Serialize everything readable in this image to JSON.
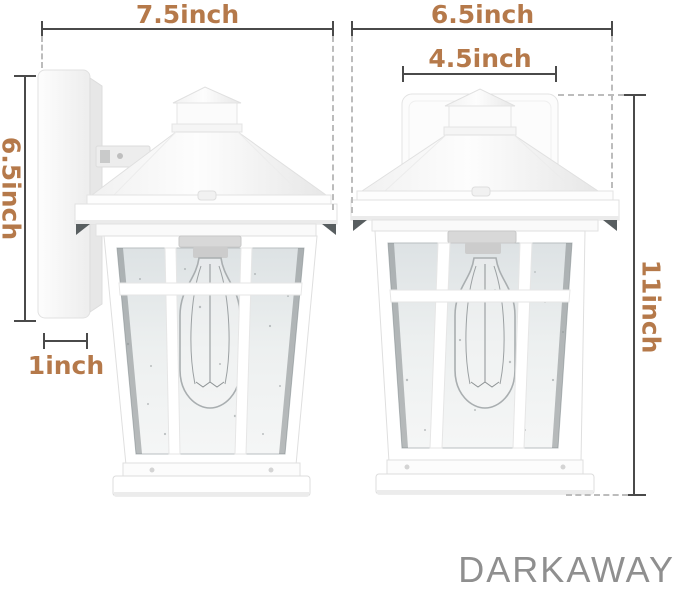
{
  "brand": "DARKAWAY",
  "dimensions": {
    "front_width": "7.5inch",
    "side_overall_width": "6.5inch",
    "backplate_width": "4.5inch",
    "backplate_height": "6.5inch",
    "backplate_depth": "1inch",
    "overall_height": "11inch"
  },
  "colors": {
    "dimension_text": "#b5794a",
    "dimension_line": "#4a4a4a",
    "extension_line": "#bcbcbc",
    "brand_text": "#8f8f8f",
    "fixture_white": "#fbfbfb",
    "glass_tint": "#e7ebec"
  }
}
